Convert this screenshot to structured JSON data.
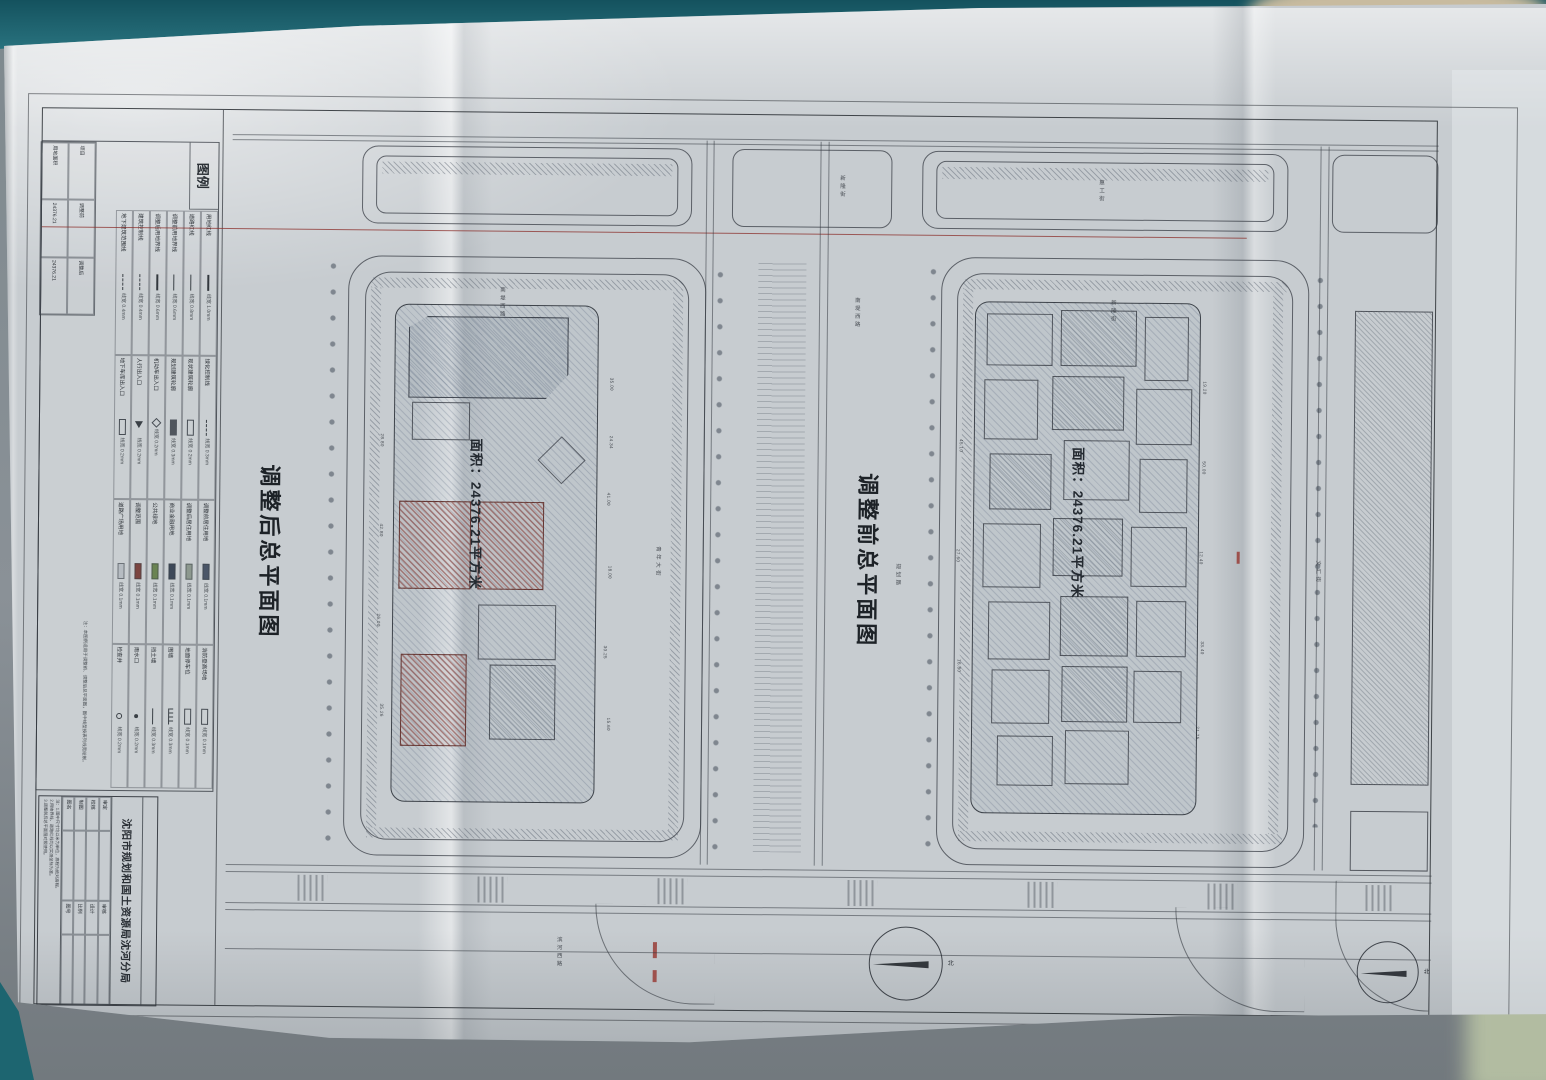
{
  "titles": {
    "after": "调整后总平面图",
    "before": "调整前总平面图"
  },
  "area_labels": {
    "after": "面积：24376.21平方米",
    "before": "面积：24376.21平方米"
  },
  "compass_label": "北",
  "legend": {
    "header": "图例",
    "entries": [
      {
        "name": "用地红线",
        "sym": "line-bold",
        "spec": "线宽 1.0mm"
      },
      {
        "name": "道路红线",
        "sym": "line",
        "spec": "线宽 0.8mm"
      },
      {
        "name": "调整前用地界线",
        "sym": "line",
        "spec": "线宽 0.6mm"
      },
      {
        "name": "调整后用地界线",
        "sym": "line-bold",
        "spec": "线宽 0.6mm"
      },
      {
        "name": "建筑控制线",
        "sym": "dash",
        "spec": "线宽 0.4mm"
      },
      {
        "name": "地下建筑范围线",
        "sym": "dash",
        "spec": "线宽 0.4mm"
      },
      {
        "name": "绿化控制线",
        "sym": "dash",
        "spec": "线宽 0.3mm"
      },
      {
        "name": "现状建筑轮廓",
        "sym": "rect",
        "spec": "线宽 0.2mm"
      },
      {
        "name": "规划建筑轮廓",
        "sym": "rect-dark",
        "spec": "线宽 0.3mm"
      },
      {
        "name": "机动车出入口",
        "sym": "diamond",
        "spec": "线宽 0.2mm"
      },
      {
        "name": "人行出入口",
        "sym": "arrow",
        "spec": "线宽 0.2mm"
      },
      {
        "name": "地下车库出入口",
        "sym": "rect",
        "spec": "线宽 0.2mm"
      },
      {
        "name": "调整前居住用地",
        "sym": "swatch",
        "color": "#4a5668",
        "spec": "线宽 0.1mm"
      },
      {
        "name": "调整后居住用地",
        "sym": "swatch",
        "color": "#8c988e",
        "spec": "线宽 0.1mm"
      },
      {
        "name": "商业金融用地",
        "sym": "swatch",
        "color": "#3c4858",
        "spec": "线宽 0.1mm"
      },
      {
        "name": "公共绿地",
        "sym": "swatch",
        "color": "#6a8452",
        "spec": "线宽 0.1mm"
      },
      {
        "name": "调整范围",
        "sym": "swatch",
        "color": "#7c4540",
        "spec": "线宽 0.1mm"
      },
      {
        "name": "道路广场用地",
        "sym": "swatch",
        "color": "#b6bcc2",
        "spec": "线宽 0.1mm"
      },
      {
        "name": "消防登高场地",
        "sym": "rect",
        "spec": "线宽 0.1mm"
      },
      {
        "name": "地面停车位",
        "sym": "rect",
        "spec": "线宽 0.1mm"
      },
      {
        "name": "围墙",
        "sym": "ticks",
        "spec": "线宽 0.3mm"
      },
      {
        "name": "挡土墙",
        "sym": "line",
        "spec": "线宽 0.3mm"
      },
      {
        "name": "雨水口",
        "sym": "dot",
        "spec": "线宽 0.2mm"
      },
      {
        "name": "检查井",
        "sym": "circle",
        "spec": "线宽 0.2mm"
      }
    ],
    "subtable": [
      [
        "项目",
        "调整前",
        "调整后"
      ],
      [
        "用地面积",
        "24376.21",
        "24376.21"
      ]
    ],
    "note": "注：本图例适用于调整前、调整后总平面图，图中线型按表列线宽绘制。"
  },
  "title_block": {
    "agency": "沈阳市规划和国土资源局沈河分局",
    "fields": [
      [
        "审定",
        ""
      ],
      [
        "审核",
        ""
      ],
      [
        "校核",
        ""
      ],
      [
        "设计",
        ""
      ],
      [
        "制图",
        ""
      ],
      [
        "比例",
        ""
      ],
      [
        "图名",
        ""
      ],
      [
        "图号",
        ""
      ]
    ],
    "notes": [
      "注：1.图中尺寸均以米为单位，高程为绝对高程。",
      "2.用地界线、道路红线均以实测坐标为准。",
      "3.调整前后总平面图对照使用。"
    ]
  },
  "street_labels": [
    "南堤西路",
    "新隆街",
    "惠工街",
    "南堤西路",
    "新隆街",
    "滨河西路",
    "青年大街",
    "规划路",
    "文汇街"
  ],
  "dimension_labels": [
    "35.00",
    "24.34",
    "41.00",
    "18.00",
    "30.25",
    "15.60",
    "28.80",
    "42.80",
    "26.00",
    "35.26",
    "19.20",
    "50.00",
    "12.40",
    "33.40",
    "21.75",
    "45.10",
    "27.60",
    "16.80"
  ]
}
